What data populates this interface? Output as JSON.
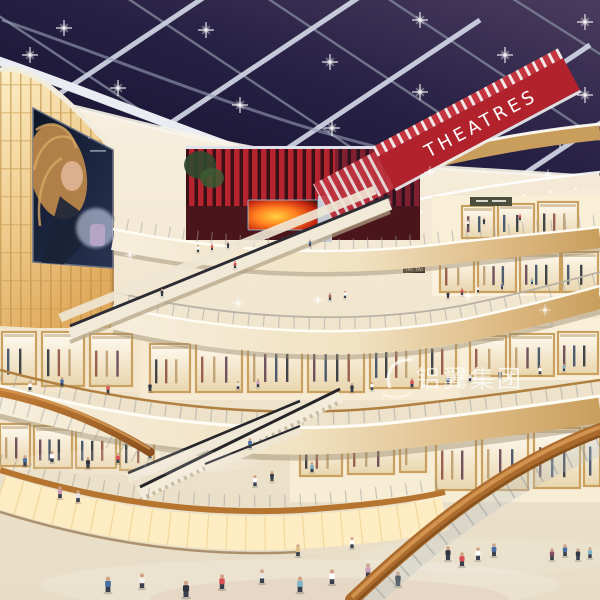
{
  "scene": {
    "title": "Shopping mall atrium interior - night rendering",
    "signs": {
      "theatres": "THEATRES",
      "tai_tai_upper": "TAI TAI",
      "tai_tai_lower": "TAI TAI"
    },
    "watermark": {
      "text": "铝翼集团"
    },
    "palette": {
      "sky_dark": "#171430",
      "sky_mid": "#262044",
      "sky_purple": "#473a5c",
      "beam_bright": "#cdd2e2",
      "beam_dim": "#7d8296",
      "theater_red": "#b1222c",
      "slat_red": "#b5242f",
      "slat_gap": "#3a1016",
      "interior_cream": "#f2e7d2",
      "fascia_cream": "#f1e2c2",
      "fascia_wood": "#c99e5c",
      "amber_panel": "#f0cf92",
      "glow_panel": "#ffedc2",
      "wood_rail": "#a96a2c",
      "floor": "#e9e0cd",
      "led_fire": "#ff7a1e",
      "glass": "#cfd9da"
    },
    "lights": [
      [
        30,
        55
      ],
      [
        118,
        88
      ],
      [
        206,
        30
      ],
      [
        150,
        140
      ],
      [
        240,
        105
      ],
      [
        330,
        62
      ],
      [
        420,
        20
      ],
      [
        332,
        128
      ],
      [
        420,
        92
      ],
      [
        505,
        55
      ],
      [
        585,
        22
      ],
      [
        508,
        118
      ],
      [
        585,
        95
      ],
      [
        560,
        140
      ],
      [
        64,
        28
      ]
    ],
    "sparkles": [
      [
        318,
        300
      ],
      [
        468,
        296
      ],
      [
        238,
        303
      ],
      [
        548,
        175
      ],
      [
        430,
        172
      ],
      [
        130,
        255
      ],
      [
        545,
        310
      ]
    ],
    "people": [
      [
        108,
        592,
        17,
        "#4a6fa5"
      ],
      [
        142,
        588,
        16,
        "#f2f0ec"
      ],
      [
        186,
        597,
        18,
        "#2f3440"
      ],
      [
        222,
        589,
        16,
        "#d94f55"
      ],
      [
        262,
        583,
        15,
        "#e8e6e2"
      ],
      [
        300,
        592,
        17,
        "#7fb4c9"
      ],
      [
        332,
        584,
        16,
        "#ffffff"
      ],
      [
        368,
        577,
        15,
        "#caa0b8"
      ],
      [
        398,
        586,
        16,
        "#2f3440"
      ],
      [
        298,
        556,
        13,
        "#e0c084"
      ],
      [
        352,
        548,
        12,
        "#ffffff"
      ],
      [
        448,
        560,
        15,
        "#2f3440"
      ],
      [
        462,
        566,
        15,
        "#d94f55"
      ],
      [
        478,
        560,
        14,
        "#ffffff"
      ],
      [
        494,
        556,
        14,
        "#4a6fa5"
      ],
      [
        552,
        560,
        13,
        "#8a4f5f"
      ],
      [
        565,
        556,
        13,
        "#4a6fa5"
      ],
      [
        578,
        560,
        13,
        "#333a45"
      ],
      [
        590,
        558,
        12,
        "#7fb4c9"
      ],
      [
        25,
        466,
        12,
        "#4a6fa5"
      ],
      [
        52,
        462,
        12,
        "#ffffff"
      ],
      [
        88,
        468,
        12,
        "#2f3440"
      ],
      [
        118,
        463,
        11,
        "#d94f55"
      ],
      [
        60,
        498,
        13,
        "#caa0b8"
      ],
      [
        78,
        502,
        13,
        "#e8e6e2"
      ],
      [
        255,
        486,
        12,
        "#ffffff"
      ],
      [
        272,
        481,
        11,
        "#333a45"
      ],
      [
        312,
        472,
        11,
        "#7fb4c9"
      ],
      [
        150,
        458,
        11,
        "#e0c084"
      ],
      [
        352,
        392,
        10,
        "#2f3440"
      ],
      [
        372,
        390,
        9,
        "#ffffff"
      ],
      [
        412,
        387,
        10,
        "#d94f55"
      ],
      [
        448,
        384,
        9,
        "#4a6fa5"
      ],
      [
        470,
        381,
        9,
        "#e8e6e2"
      ],
      [
        500,
        378,
        9,
        "#333a45"
      ],
      [
        540,
        374,
        9,
        "#ffffff"
      ],
      [
        564,
        371,
        8,
        "#7fb4c9"
      ],
      [
        30,
        390,
        10,
        "#ffffff"
      ],
      [
        62,
        386,
        10,
        "#4a6fa5"
      ],
      [
        108,
        393,
        10,
        "#d94f55"
      ],
      [
        150,
        391,
        10,
        "#2f3440"
      ],
      [
        238,
        389,
        9,
        "#e8e6e2"
      ],
      [
        258,
        387,
        9,
        "#caa0b8"
      ],
      [
        448,
        298,
        8,
        "#2f3440"
      ],
      [
        462,
        295,
        8,
        "#d94f55"
      ],
      [
        478,
        292,
        7,
        "#ffffff"
      ],
      [
        502,
        289,
        7,
        "#4a6fa5"
      ],
      [
        532,
        284,
        7,
        "#7fb4c9"
      ],
      [
        330,
        300,
        8,
        "#b06a5a"
      ],
      [
        345,
        298,
        8,
        "#ffffff"
      ],
      [
        198,
        252,
        8,
        "#ffffff"
      ],
      [
        212,
        250,
        7,
        "#d94f55"
      ],
      [
        228,
        248,
        7,
        "#2f3440"
      ],
      [
        310,
        246,
        7,
        "#4a6fa5"
      ],
      [
        468,
        226,
        7,
        "#ffffff"
      ],
      [
        484,
        224,
        7,
        "#2f3440"
      ],
      [
        520,
        220,
        7,
        "#d94f55"
      ],
      [
        235,
        268,
        8,
        "#d94f55"
      ],
      [
        162,
        296,
        8,
        "#2f3440"
      ],
      [
        250,
        448,
        11,
        "#4a6fa5"
      ],
      [
        525,
        470,
        12,
        "#c9607a"
      ]
    ],
    "shops": [
      [
        462,
        206,
        32,
        32
      ],
      [
        498,
        204,
        36,
        34
      ],
      [
        538,
        202,
        40,
        36
      ],
      [
        440,
        256,
        34,
        36
      ],
      [
        478,
        254,
        38,
        38
      ],
      [
        520,
        252,
        40,
        40
      ],
      [
        562,
        252,
        36,
        40
      ],
      [
        150,
        344,
        40,
        48
      ],
      [
        196,
        340,
        46,
        52
      ],
      [
        248,
        336,
        54,
        56
      ],
      [
        308,
        334,
        56,
        58
      ],
      [
        370,
        332,
        50,
        56
      ],
      [
        426,
        332,
        30,
        52
      ],
      [
        470,
        336,
        36,
        40
      ],
      [
        510,
        334,
        44,
        42
      ],
      [
        558,
        332,
        40,
        42
      ],
      [
        2,
        332,
        34,
        52
      ],
      [
        42,
        332,
        42,
        54
      ],
      [
        90,
        334,
        42,
        52
      ],
      [
        0,
        424,
        30,
        42
      ],
      [
        34,
        426,
        38,
        42
      ],
      [
        76,
        428,
        40,
        40
      ],
      [
        120,
        432,
        34,
        38
      ],
      [
        436,
        432,
        40,
        58
      ],
      [
        482,
        430,
        46,
        60
      ],
      [
        534,
        428,
        46,
        60
      ],
      [
        584,
        428,
        16,
        58
      ],
      [
        300,
        436,
        42,
        40
      ],
      [
        348,
        434,
        46,
        40
      ],
      [
        400,
        434,
        26,
        38
      ]
    ]
  }
}
